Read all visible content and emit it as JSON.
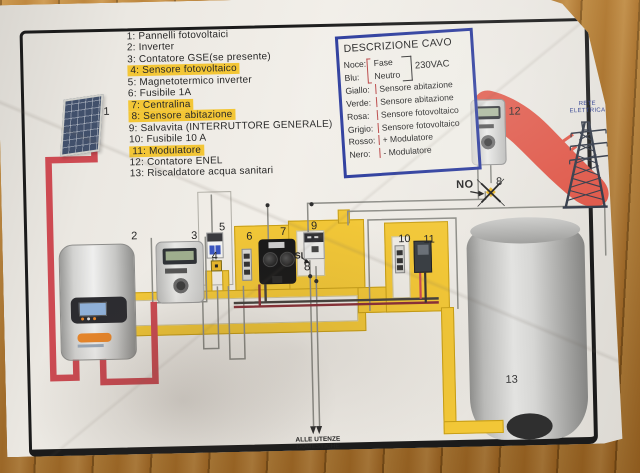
{
  "legend": {
    "items": [
      {
        "label": "1: Pannelli fotovoltaici",
        "highlighted": false
      },
      {
        "label": "2: Inverter",
        "highlighted": false
      },
      {
        "label": "3: Contatore GSE(se presente)",
        "highlighted": false
      },
      {
        "label": "4: Sensore fotovoltaico",
        "highlighted": true
      },
      {
        "label": "5: Magnetotermico inverter",
        "highlighted": false
      },
      {
        "label": "6: Fusibile 1A",
        "highlighted": false
      },
      {
        "label": "7: Centralina",
        "highlighted": true
      },
      {
        "label": "8: Sensore abitazione",
        "highlighted": true
      },
      {
        "label": "9: Salvavita (INTERRUTTORE GENERALE)",
        "highlighted": false
      },
      {
        "label": "10: Fusibile 10 A",
        "highlighted": false
      },
      {
        "label": "11: Modulatore",
        "highlighted": true
      },
      {
        "label": "12: Contatore ENEL",
        "highlighted": false
      },
      {
        "label": "13: Riscaldatore acqua sanitari",
        "highlighted": false
      }
    ]
  },
  "cable_box": {
    "title": "DESCRIZIONE CAVO",
    "voltage": "230VAC",
    "rows": [
      {
        "color": "Noce:",
        "desc": "Fase"
      },
      {
        "color": "Blu:",
        "desc": "Neutro"
      },
      {
        "color": "Giallo:",
        "desc": "Sensore abitazione"
      },
      {
        "color": "Verde:",
        "desc": "Sensore abitazione"
      },
      {
        "color": "Rosa:",
        "desc": "Sensore fotovoltaico"
      },
      {
        "color": "Grigio:",
        "desc": "Sensore fotovoltaico"
      },
      {
        "color": "Rosso:",
        "desc": "+ Modulatore"
      },
      {
        "color": "Nero:",
        "desc": "- Modulatore"
      }
    ]
  },
  "diagram": {
    "component_numbers": {
      "panel": "1",
      "inverter": "2",
      "gse_meter": "3",
      "pv_sensor": "4",
      "inverter_breaker": "5",
      "fuse_1a": "6",
      "centralina": "7",
      "home_sensor": "8",
      "salvavita": "9",
      "fuse_10a": "10",
      "modulatore": "11",
      "enel_meter": "12",
      "boiler": "13"
    },
    "markers": {
      "no": "NO",
      "no_number": "8",
      "si": "SI",
      "si_number": "8"
    },
    "captions": {
      "grid": "RETE ELETTRICA",
      "loads": "ALLE UTENZE DOMESTICHE"
    }
  },
  "colors": {
    "wire_red": "#cd4a52",
    "power_band_red": "#df5748",
    "channel_yellow": "#f2c737",
    "channel_border": "#c79e17",
    "highlight_yellow": "#f3c636",
    "cable_box_blue": "#2a3a9c",
    "paper": "#edeae4",
    "wood": "#b5772e"
  }
}
